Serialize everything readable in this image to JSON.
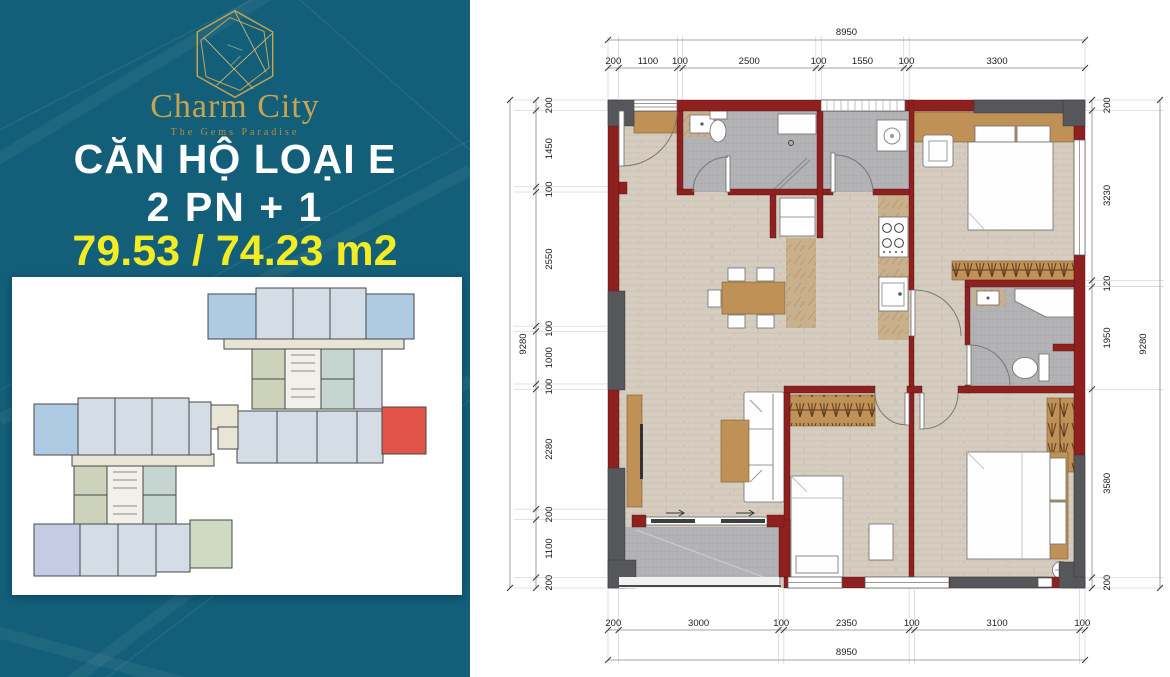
{
  "left_panel": {
    "brand": "Charm City",
    "tagline": "The Gems Paradise",
    "unit_title": "CĂN HỘ LOẠI E",
    "unit_subtitle": "2 PN + 1",
    "area_text": "79.53 / 74.23 m2",
    "colors": {
      "background": "#135E79",
      "accent_gold": "#C8A350",
      "area_yellow": "#F3EC25",
      "title_white": "#FFFFFF"
    }
  },
  "key_plan": {
    "highlight_color": "#E2544A"
  },
  "floor_plan": {
    "wall_color": "#8E2020",
    "column_color": "#56575A",
    "dimensions": {
      "top": {
        "total": "8950",
        "segments": [
          "200",
          "1100",
          "100",
          "2500",
          "100",
          "1550",
          "100",
          "3300"
        ]
      },
      "bottom": {
        "total": "8950",
        "segments": [
          "200",
          "3000",
          "100",
          "2350",
          "100",
          "3100",
          "100"
        ]
      },
      "left": {
        "total": "9280",
        "segments": [
          "200",
          "1450",
          "100",
          "2550",
          "100",
          "1000",
          "100",
          "2280",
          "200",
          "1100",
          "200"
        ]
      },
      "right": {
        "total": "9280",
        "segments": [
          "200",
          "3230",
          "120",
          "1950",
          "3580",
          "200"
        ]
      }
    }
  }
}
